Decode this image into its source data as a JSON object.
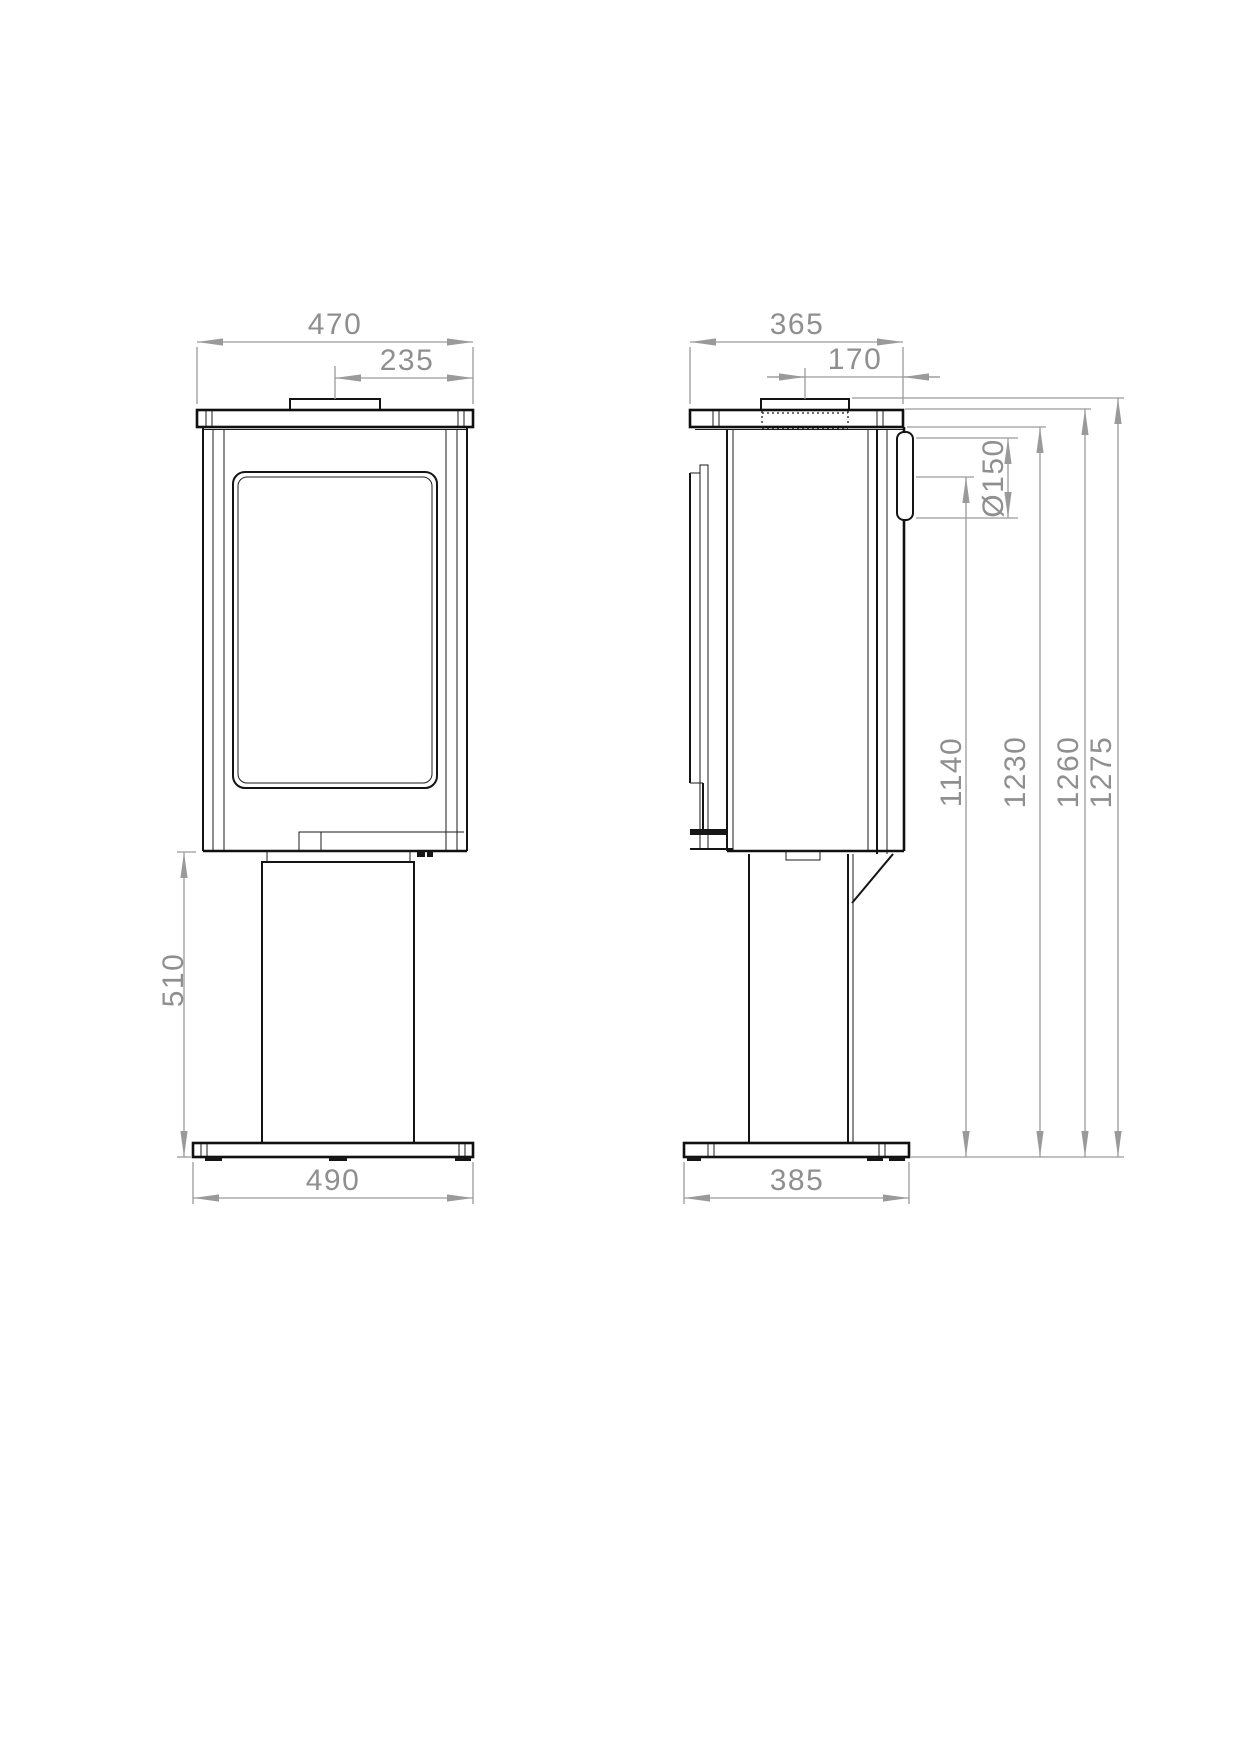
{
  "drawing": {
    "type": "technical-dimension-drawing",
    "views": {
      "left": "front elevation of stove on pedestal",
      "right": "side elevation of stove on pedestal"
    },
    "colors": {
      "background": "#ffffff",
      "outline": "#141414",
      "dimension": "#9a9a9a",
      "dimension_text": "#8f8f8f"
    },
    "dims": {
      "front_overall_width": "470",
      "front_flue_center_offset": "235",
      "front_pedestal_height": "510",
      "front_base_width": "490",
      "side_overall_depth": "365",
      "side_flue_center_to_back": "170",
      "flue_diameter": "Ø150",
      "height_to_flue_center": "1140",
      "height_to_body_top": "1230",
      "height_to_top_plate": "1260",
      "overall_height": "1275",
      "side_base_depth": "385"
    }
  }
}
